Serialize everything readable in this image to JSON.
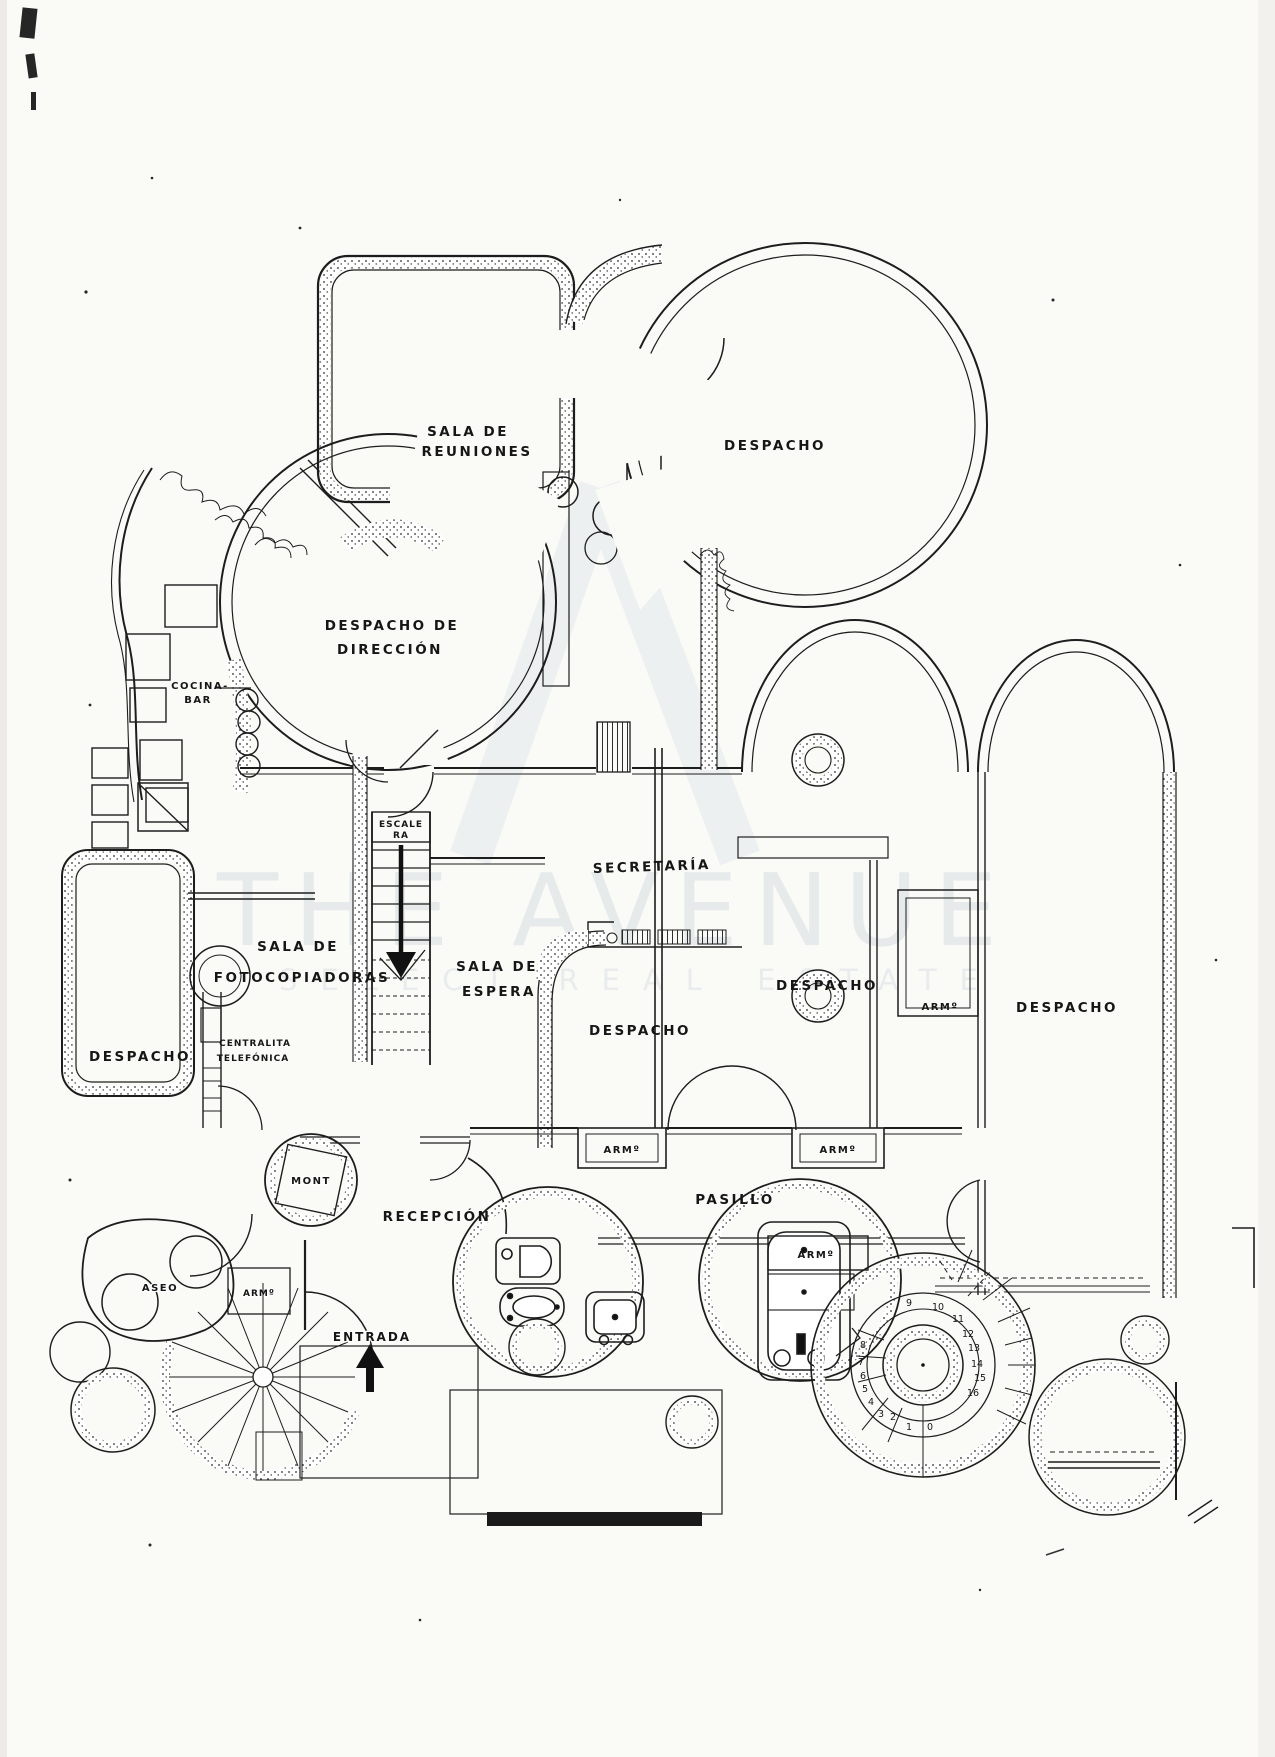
{
  "watermark": {
    "logo": "A",
    "title": "THE AVENUE",
    "subtitle": "SELECT REAL ESTATE"
  },
  "rooms": {
    "sala_reuniones_l1": "SALA  DE",
    "sala_reuniones_l2": "REUNIONES",
    "despacho_top": "DESPACHO",
    "direccion_l1": "DESPACHO  DE",
    "direccion_l2": "DIRECCIÓN",
    "cocina_l1": "COCINA-",
    "cocina_l2": "BAR",
    "escalera_l1": "ESCALE",
    "escalera_l2": "RA",
    "secretaria": "SECRETARÍA",
    "fotocopiadoras_l1": "SALA  DE",
    "fotocopiadoras_l2": "FOTOCOPIADORAS",
    "espera_l1": "SALA  DE",
    "espera_l2": "ESPERA",
    "despacho_centro": "DESPACHO",
    "despacho_derecha": "DESPACHO",
    "despacho_fondo": "DESPACHO",
    "despacho_izquierda": "DESPACHO",
    "centralita_l1": "CENTRALITA",
    "centralita_l2": "TELEFÓNICA",
    "montacargas": "MONT",
    "recepcion": "RECEPCIÓN",
    "pasillo": "PASILLO",
    "armario": "ARMº",
    "aseo": "ASEO",
    "entrada": "ENTRADA"
  },
  "stairs": {
    "numbers": [
      "0",
      "1",
      "2",
      "3",
      "4",
      "5",
      "6",
      "7",
      "8",
      "9",
      "10",
      "11",
      "12",
      "13",
      "14",
      "15",
      "16"
    ]
  },
  "colors": {
    "ink": "#1d1d1d",
    "paper": "#fafaf7",
    "watermark": "#e7eaeb"
  }
}
